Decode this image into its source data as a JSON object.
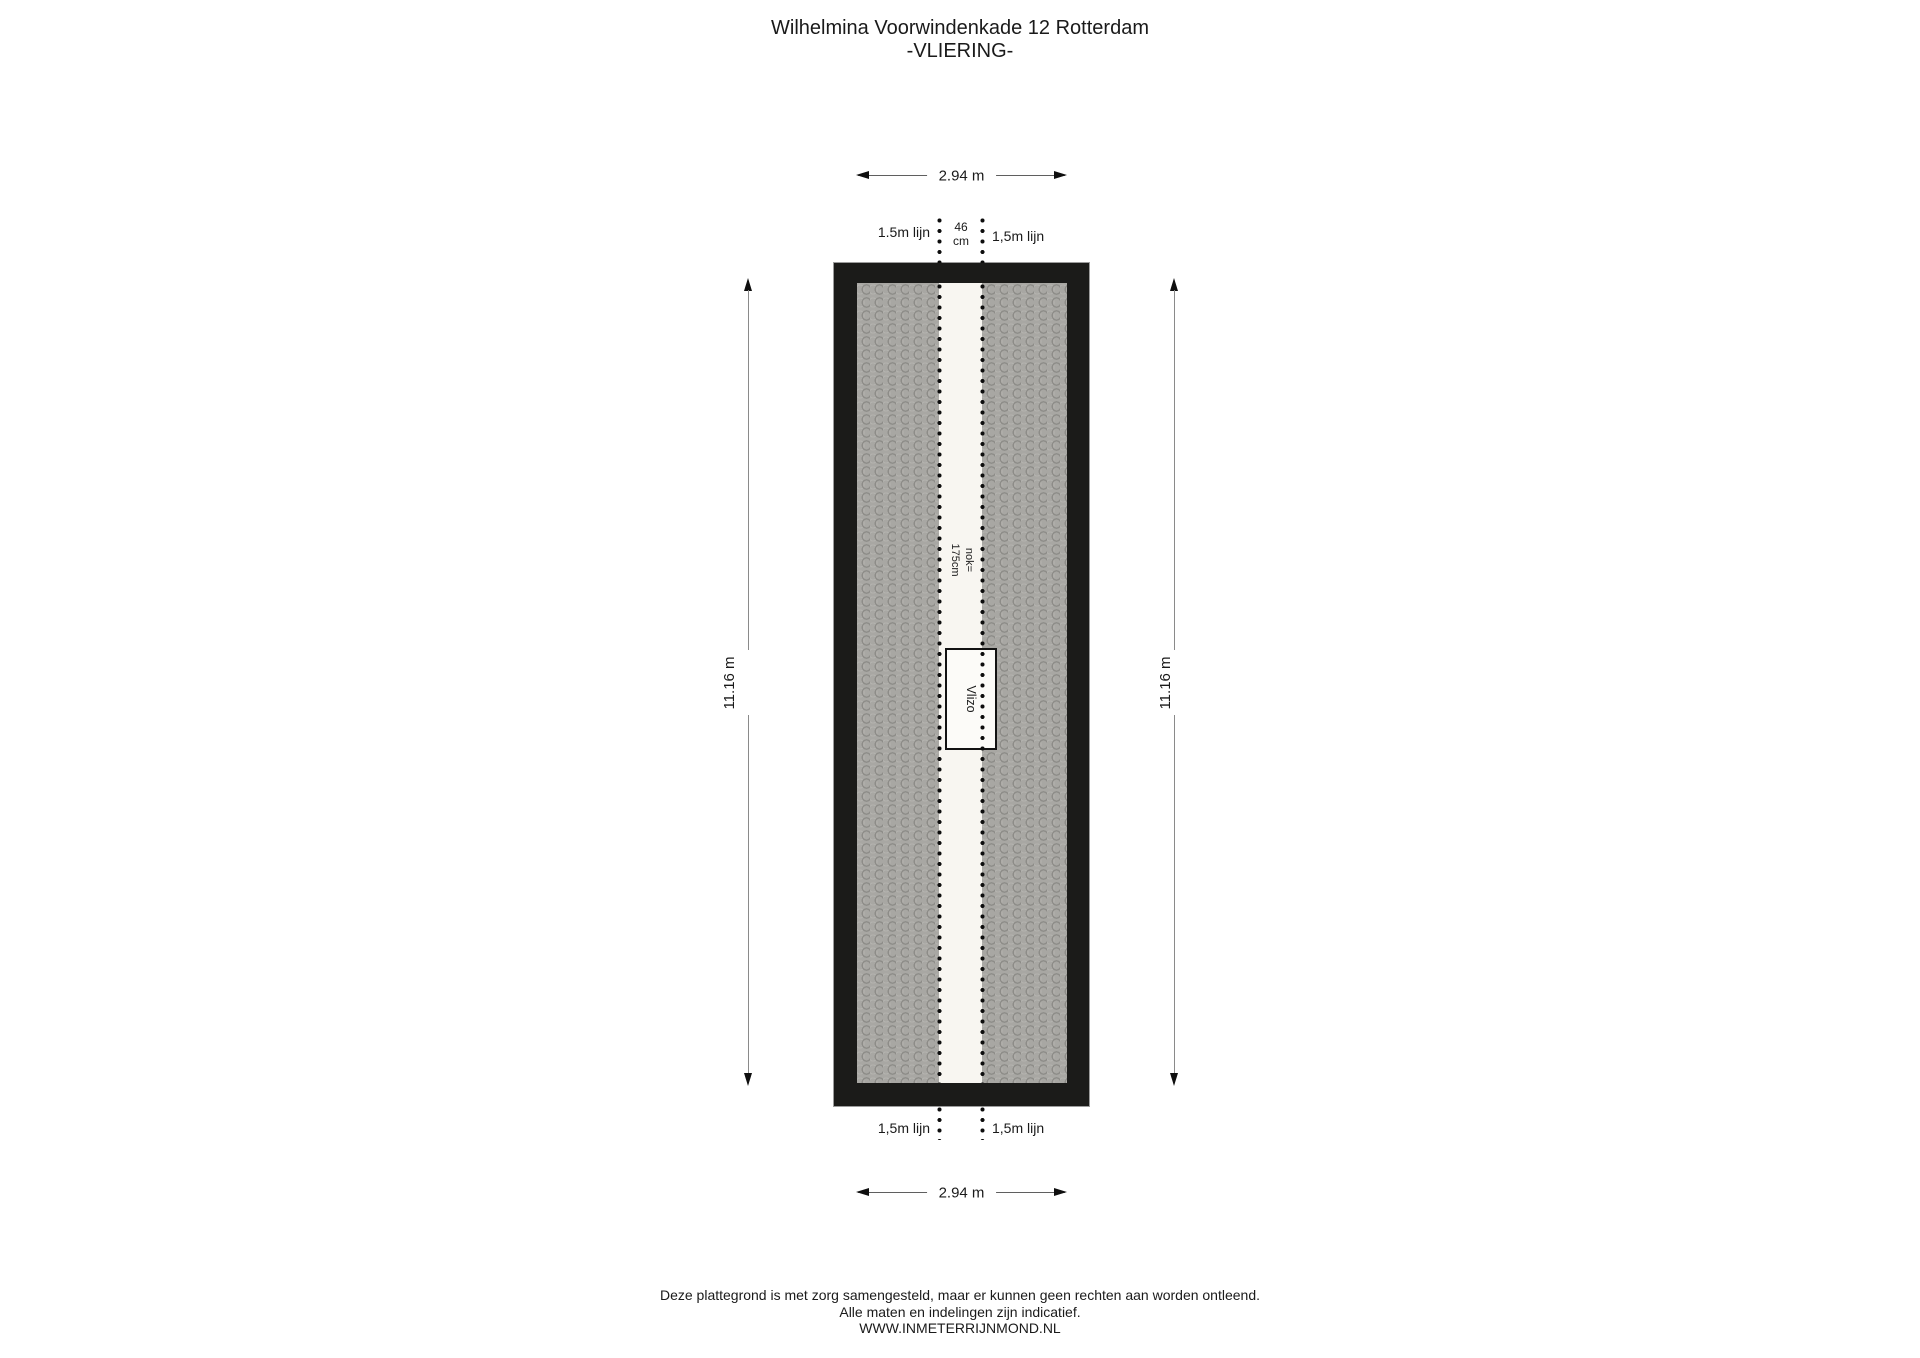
{
  "page": {
    "title_line1": "Wilhelmina Voorwindenkade 12 Rotterdam",
    "title_line2": "-VLIERING-"
  },
  "floorplan": {
    "floor_name": "VLIERING",
    "dim_top": "2.94 m",
    "dim_bottom": "2.94 m",
    "dim_left": "11.16 m",
    "dim_right": "11.16 m",
    "line_label_top_left": "1.5m lijn",
    "line_label_top_right": "1,5m lijn",
    "line_label_bottom_left": "1,5m lijn",
    "line_label_bottom_right": "1,5m lijn",
    "gap_label_line1": "46",
    "gap_label_line2": "cm",
    "ridge_label_line1": "nok=",
    "ridge_label_line2": "175cm",
    "hatch_label": "Vlizo"
  },
  "footer": {
    "line1": "Deze plattegrond is met zorg samengesteld, maar er kunnen geen rechten aan worden ontleend.",
    "line2": "Alle maten en indelingen zijn indicatief.",
    "line3": "WWW.INMETERRIJNMOND.NL"
  },
  "colors": {
    "wall": "#1b1b19",
    "hatch_base": "#a8a7a3",
    "hatch_arc_dark": "#8d8c88",
    "hatch_arc_light": "#b3b2ae",
    "ridge_strip": "#f8f6f1",
    "dotted_line": "#0d0d0d",
    "dimension_line": "#5f5f5f",
    "text": "#1a1a1a"
  }
}
